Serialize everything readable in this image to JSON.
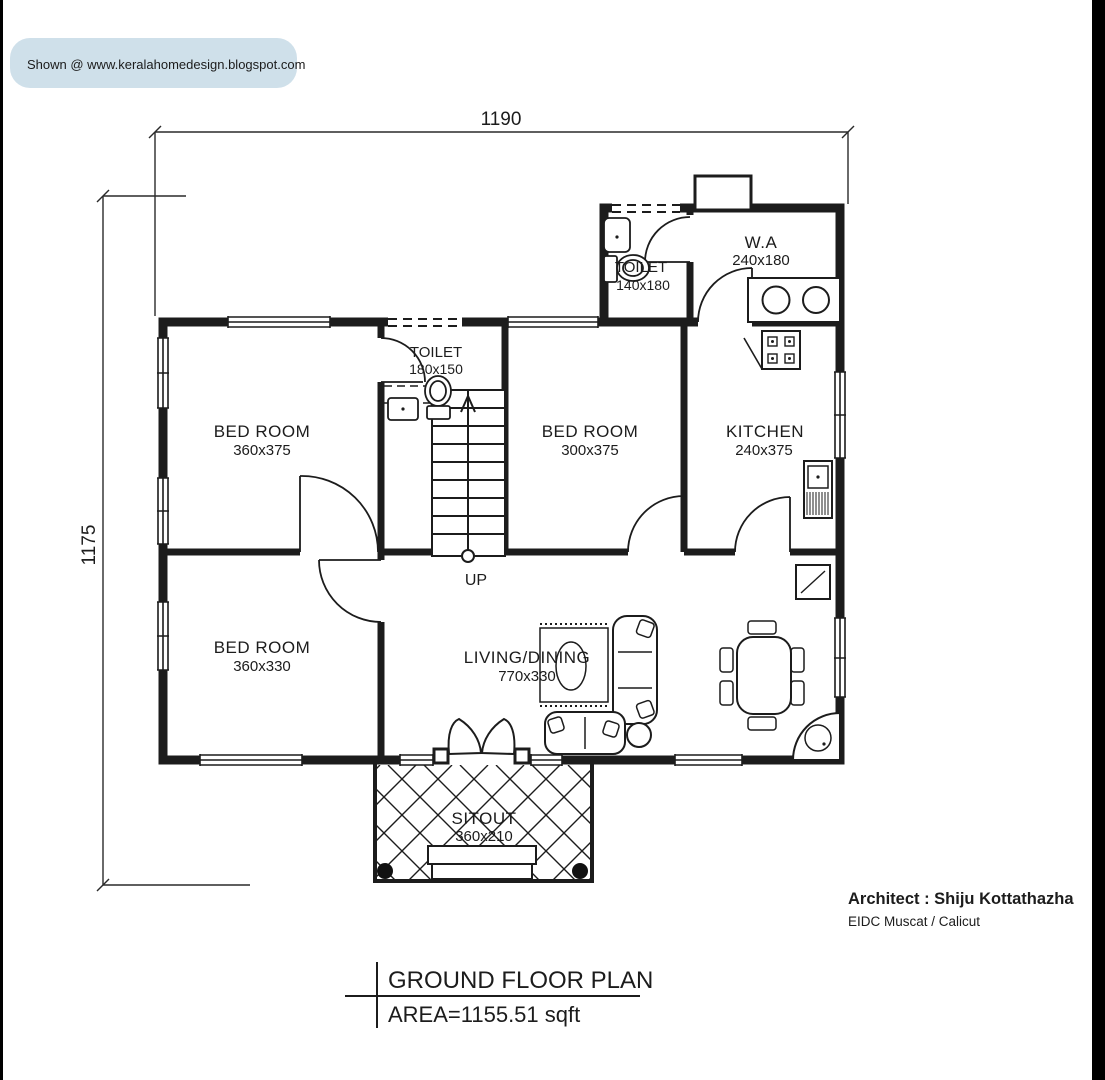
{
  "badge": {
    "text": "Shown @  www.keralahomedesign.blogspot.com",
    "bg": "#cfe0ea"
  },
  "dimensions": {
    "width_label": "1190",
    "height_label": "1175"
  },
  "rooms": {
    "toilet_upper": {
      "name": "TOILET",
      "size": "140x180"
    },
    "work_area": {
      "name": "W.A",
      "size": "240x180"
    },
    "toilet_mid": {
      "name": "TOILET",
      "size": "180x150"
    },
    "bedroom_1": {
      "name": "BED ROOM",
      "size": "360x375"
    },
    "bedroom_2": {
      "name": "BED ROOM",
      "size": "300x375"
    },
    "kitchen": {
      "name": "KITCHEN",
      "size": "240x375"
    },
    "bedroom_3": {
      "name": "BED ROOM",
      "size": "360x330"
    },
    "living_dining": {
      "name": "LIVING/DINING",
      "size": "770x330"
    },
    "sitout": {
      "name": "SITOUT",
      "size": "360x210"
    },
    "stairs_label": "UP"
  },
  "title_block": {
    "title": "GROUND FLOOR PLAN",
    "area": "AREA=1155.51 sqft"
  },
  "credits": {
    "architect": "Architect : Shiju Kottathazha",
    "firm": "EIDC Muscat / Calicut",
    "accent_color": "#cc2236"
  },
  "frame_color": "#000000",
  "line_color": "#1c1c1c"
}
